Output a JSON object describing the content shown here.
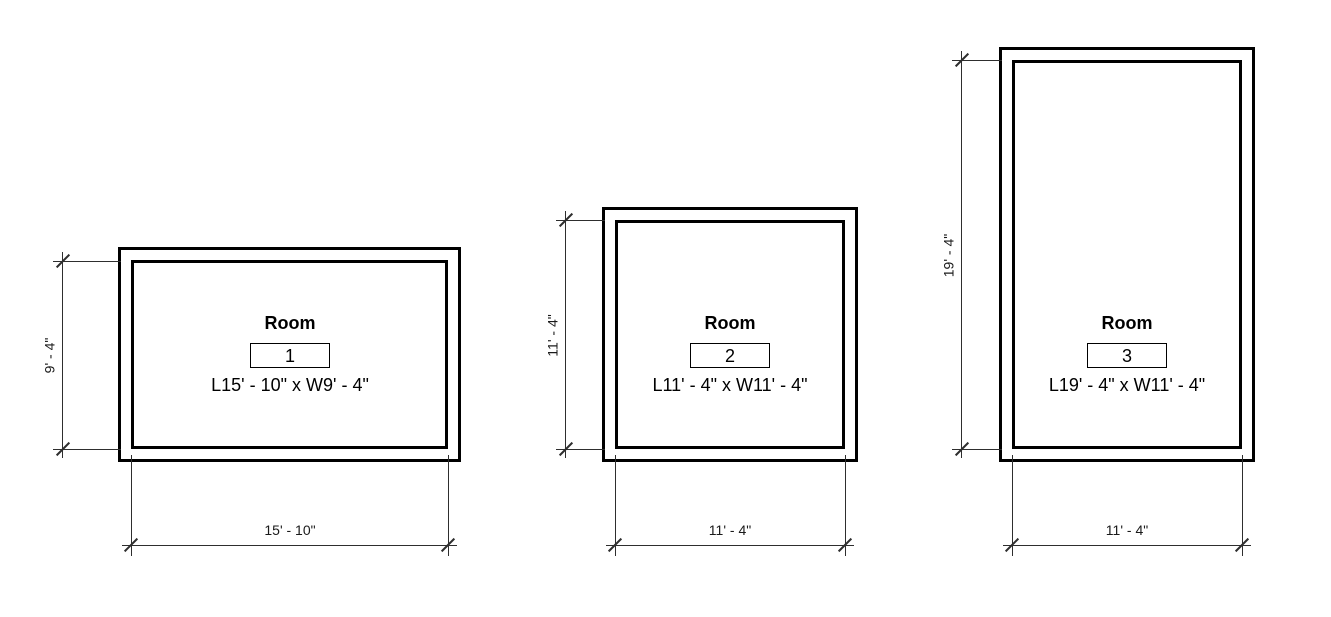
{
  "rooms": [
    {
      "label": "Room",
      "number": "1",
      "size_label": "L15' - 10\" x W9' - 4\"",
      "height_dim": "9' - 4\"",
      "width_dim": "15' - 10\""
    },
    {
      "label": "Room",
      "number": "2",
      "size_label": "L11' - 4\" x W11' - 4\"",
      "height_dim": "11' - 4\"",
      "width_dim": "11' - 4\""
    },
    {
      "label": "Room",
      "number": "3",
      "size_label": "L19' - 4\" x W11' - 4\"",
      "height_dim": "19' - 4\"",
      "width_dim": "11' - 4\""
    }
  ],
  "colors": {
    "wall": "#000000",
    "dimension_line": "#2e2e2e",
    "background": "#ffffff"
  }
}
